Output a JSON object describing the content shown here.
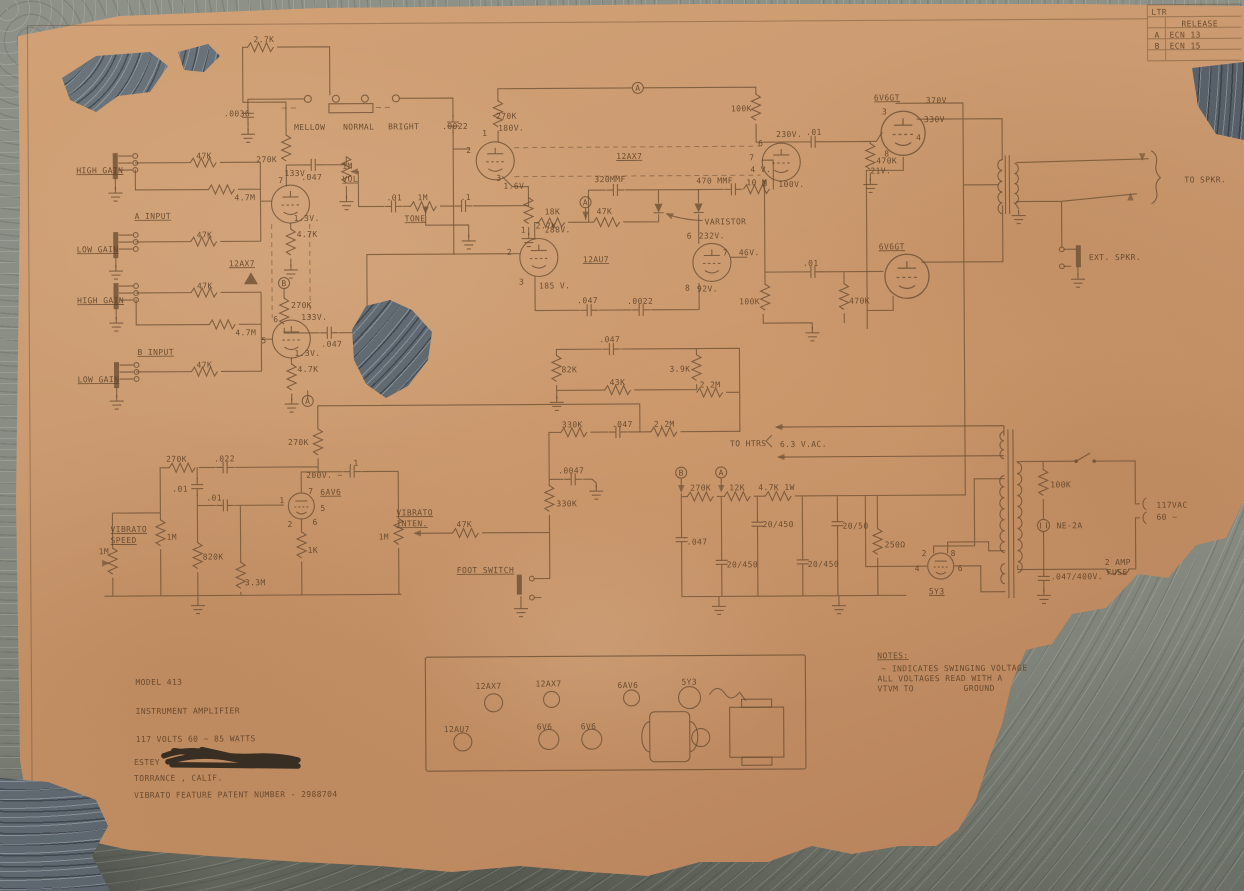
{
  "title_block": {
    "model": "MODEL 413",
    "product": "INSTRUMENT AMPLIFIER",
    "power_rating": "117 VOLTS 60 ~  85 WATTS",
    "manufacturer": "ESTEY",
    "location": "TORRANCE , CALIF.",
    "patent_line": "VIBRATO FEATURE PATENT NUMBER - 2988704"
  },
  "notes": {
    "heading": "NOTES:",
    "line1": "~ INDICATES SWINGING VOLTAGE",
    "line2": "ALL VOLTAGES READ WITH A",
    "line3": "VTVM TO",
    "line4": "GROUND"
  },
  "revision_table": {
    "col_header": "LTR",
    "rows": [
      [
        "",
        "RELEASE"
      ],
      [
        "A",
        "ECN 13"
      ],
      [
        "B",
        "ECN 15"
      ]
    ]
  },
  "schematic_summary": {
    "tube_complement": [
      "12AX7",
      "12AX7",
      "12AU7",
      "6AV6",
      "6V6GT",
      "6V6GT",
      "5Y3"
    ],
    "controls": [
      "VOL",
      "TONE",
      "VIBRATO SPEED",
      "VIBRATO INTEN."
    ],
    "voicing_switch_positions": [
      "MELLOW",
      "NORMAL",
      "BRIGHT"
    ],
    "inputs": [
      "A INPUT HIGH GAIN",
      "A INPUT LOW GAIN",
      "B INPUT HIGH GAIN",
      "B INPUT LOW GAIN"
    ],
    "outputs": [
      "TO SPKR.",
      "EXT. SPKR.",
      "FOOT SWITCH"
    ]
  },
  "colors": {
    "paper": "#c8946b",
    "ink": "#6a4d32",
    "concrete": "#878b82",
    "stone": "#5a636b"
  },
  "labels": [
    {
      "t": "HIGH GAIN",
      "x": 78,
      "y": 170,
      "u": 1
    },
    {
      "t": "LOW GAIN",
      "x": 78,
      "y": 249,
      "u": 1
    },
    {
      "t": "HIGH GAIN",
      "x": 78,
      "y": 300,
      "u": 1
    },
    {
      "t": "LOW GAIN",
      "x": 78,
      "y": 379,
      "u": 1
    },
    {
      "t": "A INPUT",
      "x": 136,
      "y": 216,
      "u": 1
    },
    {
      "t": "B INPUT",
      "x": 138,
      "y": 352,
      "u": 1
    },
    {
      "t": "47K",
      "x": 198,
      "y": 156
    },
    {
      "t": "4.7M",
      "x": 236,
      "y": 198
    },
    {
      "t": "47K",
      "x": 198,
      "y": 235
    },
    {
      "t": "47K",
      "x": 198,
      "y": 286
    },
    {
      "t": "4.7M",
      "x": 236,
      "y": 333
    },
    {
      "t": "47K",
      "x": 197,
      "y": 365
    },
    {
      "t": "12AX7",
      "x": 230,
      "y": 264,
      "u": 1
    },
    {
      "t": "270K",
      "x": 258,
      "y": 160
    },
    {
      "t": "133V.",
      "x": 286,
      "y": 174
    },
    {
      "t": ".047",
      "x": 303,
      "y": 178
    },
    {
      "t": "1M",
      "x": 344,
      "y": 167
    },
    {
      "t": "VOL",
      "x": 344,
      "y": 180,
      "u": 1
    },
    {
      "t": "7",
      "x": 280,
      "y": 181,
      "s": 7
    },
    {
      "t": "1.3V.",
      "x": 295,
      "y": 219
    },
    {
      "t": "4.7K",
      "x": 298,
      "y": 235
    },
    {
      "t": "B",
      "x": 285,
      "y": 284,
      "s": 7,
      "a": "middle"
    },
    {
      "t": "270K",
      "x": 292,
      "y": 306
    },
    {
      "t": "133V.",
      "x": 302,
      "y": 318
    },
    {
      "t": "6",
      "x": 274,
      "y": 320,
      "s": 7
    },
    {
      "t": ".047",
      "x": 322,
      "y": 345
    },
    {
      "t": "5",
      "x": 262,
      "y": 341,
      "s": 7
    },
    {
      "t": "1.3V.",
      "x": 295,
      "y": 354
    },
    {
      "t": "4.7K",
      "x": 298,
      "y": 370
    },
    {
      "t": "A",
      "x": 308,
      "y": 402,
      "s": 7,
      "a": "middle"
    },
    {
      "t": "2.7K",
      "x": 256,
      "y": 40
    },
    {
      "t": ".0036",
      "x": 226,
      "y": 114
    },
    {
      "t": "MELLOW",
      "x": 296,
      "y": 128
    },
    {
      "t": "NORMAL",
      "x": 345,
      "y": 128
    },
    {
      "t": "BRIGHT",
      "x": 390,
      "y": 128
    },
    {
      "t": ".0022",
      "x": 444,
      "y": 128
    },
    {
      "t": "270K",
      "x": 498,
      "y": 118
    },
    {
      "t": "180V.",
      "x": 500,
      "y": 130
    },
    {
      "t": "2",
      "x": 468,
      "y": 152,
      "s": 7
    },
    {
      "t": "1",
      "x": 484,
      "y": 135,
      "s": 7
    },
    {
      "t": "3",
      "x": 498,
      "y": 180,
      "s": 7
    },
    {
      "t": "1.6V",
      "x": 505,
      "y": 188
    },
    {
      "t": ".01",
      "x": 388,
      "y": 199
    },
    {
      "t": "1M",
      "x": 419,
      "y": 199
    },
    {
      "t": "TONE",
      "x": 406,
      "y": 220,
      "u": 1
    },
    {
      "t": ".1",
      "x": 462,
      "y": 199
    },
    {
      "t": "2.7K",
      "x": 537,
      "y": 228
    },
    {
      "t": "12AX7",
      "x": 618,
      "y": 159,
      "u": 1
    },
    {
      "t": "A",
      "x": 640,
      "y": 91,
      "s": 7,
      "a": "middle"
    },
    {
      "t": "100K",
      "x": 733,
      "y": 112
    },
    {
      "t": "230V.",
      "x": 778,
      "y": 138
    },
    {
      "t": ".01",
      "x": 808,
      "y": 136
    },
    {
      "t": "6",
      "x": 760,
      "y": 147,
      "s": 7
    },
    {
      "t": "7",
      "x": 751,
      "y": 161,
      "s": 7
    },
    {
      "t": "4 V.",
      "x": 752,
      "y": 173
    },
    {
      "t": "8",
      "x": 764,
      "y": 187,
      "s": 7
    },
    {
      "t": "100V.",
      "x": 780,
      "y": 188
    },
    {
      "t": "470K",
      "x": 878,
      "y": 165
    },
    {
      "t": "470 MMF",
      "x": 698,
      "y": 184
    },
    {
      "t": "10 M",
      "x": 748,
      "y": 186
    },
    {
      "t": "320MMF",
      "x": 596,
      "y": 182
    },
    {
      "t": "18K",
      "x": 546,
      "y": 214
    },
    {
      "t": "47K",
      "x": 598,
      "y": 214
    },
    {
      "t": "A",
      "x": 587,
      "y": 205,
      "s": 7,
      "a": "middle"
    },
    {
      "t": "VARISTOR",
      "x": 706,
      "y": 225
    },
    {
      "t": "1",
      "x": 522,
      "y": 232,
      "s": 7
    },
    {
      "t": "288V.",
      "x": 546,
      "y": 232
    },
    {
      "t": "2",
      "x": 508,
      "y": 254,
      "s": 7
    },
    {
      "t": "12AU7",
      "x": 584,
      "y": 262,
      "u": 1
    },
    {
      "t": "3",
      "x": 520,
      "y": 284,
      "s": 7
    },
    {
      "t": "185 V.",
      "x": 540,
      "y": 288
    },
    {
      "t": "6",
      "x": 688,
      "y": 239,
      "s": 7
    },
    {
      "t": "232V.",
      "x": 700,
      "y": 239
    },
    {
      "t": "7",
      "x": 724,
      "y": 256,
      "s": 7
    },
    {
      "t": "46V.",
      "x": 740,
      "y": 256
    },
    {
      "t": "8",
      "x": 686,
      "y": 291,
      "s": 7
    },
    {
      "t": "92V.",
      "x": 698,
      "y": 292
    },
    {
      "t": ".047",
      "x": 578,
      "y": 303
    },
    {
      "t": ".0022",
      "x": 628,
      "y": 304
    },
    {
      "t": ".047",
      "x": 600,
      "y": 342
    },
    {
      "t": "82K",
      "x": 562,
      "y": 372
    },
    {
      "t": "3.9K",
      "x": 670,
      "y": 372
    },
    {
      "t": "43K",
      "x": 610,
      "y": 385
    },
    {
      "t": "2.2M",
      "x": 700,
      "y": 388
    },
    {
      "t": ".01",
      "x": 804,
      "y": 267
    },
    {
      "t": "100K",
      "x": 740,
      "y": 305
    },
    {
      "t": "470K",
      "x": 850,
      "y": 305
    },
    {
      "t": "6V6GT",
      "x": 876,
      "y": 102,
      "u": 1
    },
    {
      "t": "370V",
      "x": 928,
      "y": 105
    },
    {
      "t": "3",
      "x": 884,
      "y": 116,
      "s": 7
    },
    {
      "t": "330V",
      "x": 926,
      "y": 124
    },
    {
      "t": "4",
      "x": 918,
      "y": 142,
      "s": 7
    },
    {
      "t": "8",
      "x": 886,
      "y": 158,
      "s": 7
    },
    {
      "t": "21V.",
      "x": 872,
      "y": 175
    },
    {
      "t": "6V6GT",
      "x": 880,
      "y": 251,
      "u": 1
    },
    {
      "t": "TO SPKR.",
      "x": 1186,
      "y": 186
    },
    {
      "t": "EXT. SPKR.",
      "x": 1090,
      "y": 263
    },
    {
      "t": "330K",
      "x": 562,
      "y": 427
    },
    {
      "t": ".047",
      "x": 612,
      "y": 427
    },
    {
      "t": "2.2M",
      "x": 654,
      "y": 427
    },
    {
      "t": "TO HTRS",
      "x": 730,
      "y": 447
    },
    {
      "t": "6.3 V.AC.",
      "x": 780,
      "y": 448
    },
    {
      "t": ".0047",
      "x": 558,
      "y": 473
    },
    {
      "t": "330K",
      "x": 556,
      "y": 506
    },
    {
      "t": "47K",
      "x": 456,
      "y": 526
    },
    {
      "t": "VIBRATO",
      "x": 396,
      "y": 514,
      "u": 1
    },
    {
      "t": "INTEN.",
      "x": 396,
      "y": 525,
      "u": 1
    },
    {
      "t": "1M",
      "x": 378,
      "y": 538
    },
    {
      "t": "FOOT SWITCH",
      "x": 456,
      "y": 572,
      "u": 1
    },
    {
      "t": "270K",
      "x": 288,
      "y": 443
    },
    {
      "t": "200V. ~",
      "x": 306,
      "y": 476
    },
    {
      "t": ".1",
      "x": 348,
      "y": 464
    },
    {
      "t": "6AV6",
      "x": 320,
      "y": 493,
      "u": 1
    },
    {
      "t": "270K",
      "x": 166,
      "y": 459
    },
    {
      "t": ".022",
      "x": 214,
      "y": 459
    },
    {
      "t": ".01",
      "x": 172,
      "y": 489
    },
    {
      "t": ".01",
      "x": 206,
      "y": 498
    },
    {
      "t": "VIBRATO",
      "x": 110,
      "y": 529,
      "u": 1
    },
    {
      "t": "SPEED",
      "x": 110,
      "y": 540,
      "u": 1
    },
    {
      "t": "1M",
      "x": 98,
      "y": 551
    },
    {
      "t": "1M",
      "x": 166,
      "y": 537
    },
    {
      "t": "820K",
      "x": 202,
      "y": 557
    },
    {
      "t": "3.3M",
      "x": 244,
      "y": 583
    },
    {
      "t": "1K",
      "x": 307,
      "y": 551
    },
    {
      "t": "1",
      "x": 279,
      "y": 501,
      "s": 6
    },
    {
      "t": "2",
      "x": 287,
      "y": 525,
      "s": 6
    },
    {
      "t": "7",
      "x": 308,
      "y": 492,
      "s": 6
    },
    {
      "t": "5",
      "x": 320,
      "y": 509,
      "s": 6
    },
    {
      "t": "6",
      "x": 312,
      "y": 523,
      "s": 6
    },
    {
      "t": "B",
      "x": 681,
      "y": 476,
      "s": 7,
      "a": "middle"
    },
    {
      "t": "A",
      "x": 721,
      "y": 476,
      "s": 7,
      "a": "middle"
    },
    {
      "t": "270K",
      "x": 690,
      "y": 491
    },
    {
      "t": "12K",
      "x": 729,
      "y": 491
    },
    {
      "t": "4.7K 1W",
      "x": 758,
      "y": 491
    },
    {
      "t": ".047",
      "x": 686,
      "y": 545
    },
    {
      "t": "20/450",
      "x": 762,
      "y": 528
    },
    {
      "t": "20/450",
      "x": 726,
      "y": 568
    },
    {
      "t": "20/450",
      "x": 807,
      "y": 568
    },
    {
      "t": "20/50",
      "x": 842,
      "y": 530
    },
    {
      "t": "250Ω",
      "x": 884,
      "y": 549
    },
    {
      "t": "5Y3",
      "x": 928,
      "y": 596,
      "u": 1
    },
    {
      "t": "2",
      "x": 921,
      "y": 558,
      "s": 6
    },
    {
      "t": "8",
      "x": 950,
      "y": 558,
      "s": 6
    },
    {
      "t": "4",
      "x": 914,
      "y": 573,
      "s": 6
    },
    {
      "t": "6",
      "x": 957,
      "y": 573,
      "s": 6
    },
    {
      "t": "100K",
      "x": 1050,
      "y": 490
    },
    {
      "t": "NE-2A",
      "x": 1056,
      "y": 531
    },
    {
      "t": ".047/400V.",
      "x": 1050,
      "y": 582
    },
    {
      "t": "2 AMP",
      "x": 1104,
      "y": 568
    },
    {
      "t": "FUSE",
      "x": 1106,
      "y": 578
    },
    {
      "t": "117VAC",
      "x": 1156,
      "y": 511
    },
    {
      "t": "60 ~",
      "x": 1156,
      "y": 523
    },
    {
      "t": "12AX7",
      "x": 474,
      "y": 688,
      "s": 7,
      "o": 0.55
    },
    {
      "t": "12AX7",
      "x": 534,
      "y": 686,
      "s": 7,
      "o": 0.5
    },
    {
      "t": "6AV6",
      "x": 616,
      "y": 688,
      "s": 7,
      "o": 0.6
    },
    {
      "t": "5Y3",
      "x": 680,
      "y": 685,
      "s": 7,
      "o": 0.6
    },
    {
      "t": "12AU7",
      "x": 442,
      "y": 731,
      "s": 7,
      "o": 0.6
    },
    {
      "t": "6V6",
      "x": 535,
      "y": 729,
      "s": 7,
      "o": 0.6
    },
    {
      "t": "6V6",
      "x": 579,
      "y": 729,
      "s": 7,
      "o": 0.6
    },
    {
      "t": "MODEL 413",
      "x": 134,
      "y": 682,
      "s": 15,
      "o": 0.8
    },
    {
      "t": "INSTRUMENT AMPLIFIER",
      "x": 134,
      "y": 711,
      "s": 15,
      "o": 0.75
    },
    {
      "t": "117 VOLTS 60 ~  85 WATTS",
      "x": 134,
      "y": 739,
      "s": 15,
      "o": 0.75
    },
    {
      "t": "ESTEY",
      "x": 132,
      "y": 762,
      "s": 12,
      "o": 0.8
    },
    {
      "t": "TORRANCE , CALIF.",
      "x": 132,
      "y": 778,
      "s": 12,
      "o": 0.75
    },
    {
      "t": "VIBRATO FEATURE PATENT NUMBER - 2988704",
      "x": 132,
      "y": 795,
      "s": 8,
      "o": 0.38
    },
    {
      "t": "NOTES:",
      "x": 876,
      "y": 660,
      "s": 9,
      "u": 1,
      "o": 0.75
    },
    {
      "t": "~ INDICATES SWINGING VOLTAGE",
      "x": 880,
      "y": 673,
      "s": 8,
      "o": 0.62
    },
    {
      "t": "ALL VOLTAGES READ WITH A",
      "x": 876,
      "y": 683,
      "s": 8,
      "o": 0.62
    },
    {
      "t": "VTVM TO",
      "x": 876,
      "y": 693,
      "s": 8,
      "o": 0.62
    },
    {
      "t": "GROUND",
      "x": 962,
      "y": 693,
      "s": 8,
      "o": 0.62
    },
    {
      "t": "LTR",
      "x": 1154,
      "y": 18,
      "s": 5,
      "o": 0.7
    },
    {
      "t": "RELEASE",
      "x": 1184,
      "y": 30,
      "s": 6,
      "o": 0.7
    },
    {
      "t": "A",
      "x": 1157,
      "y": 41,
      "s": 6,
      "o": 0.8
    },
    {
      "t": "ECN 13",
      "x": 1172,
      "y": 41,
      "s": 6,
      "o": 0.8
    },
    {
      "t": "B",
      "x": 1157,
      "y": 52,
      "s": 6,
      "o": 0.8
    },
    {
      "t": "ECN 15",
      "x": 1172,
      "y": 52,
      "s": 6,
      "o": 0.8
    }
  ]
}
